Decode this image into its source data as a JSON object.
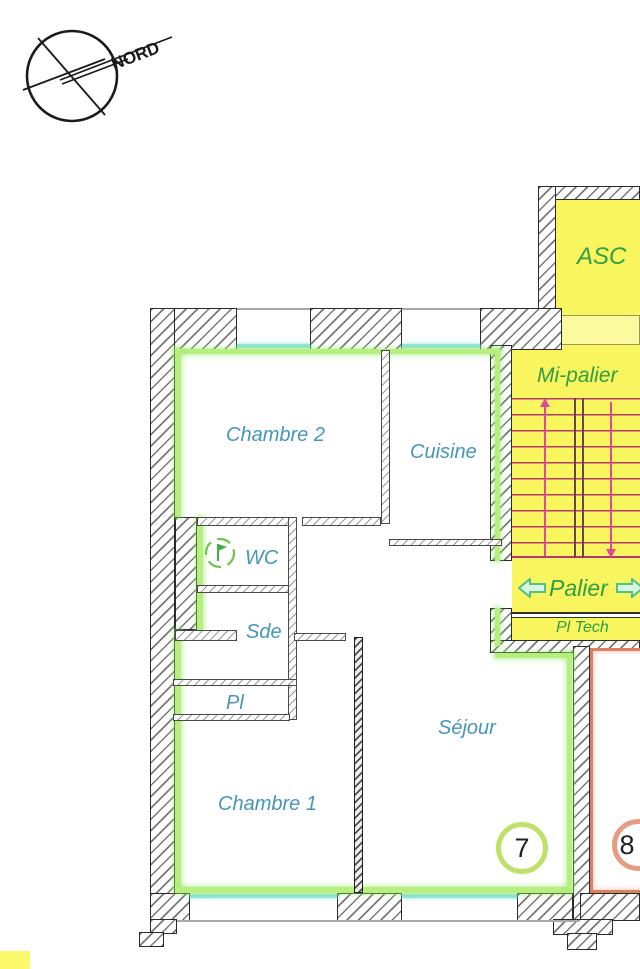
{
  "meta": {
    "type": "floor-plan",
    "orientation_label": "NORD"
  },
  "compass": {
    "north_label": "NORD"
  },
  "common_areas": {
    "elevator": "ASC",
    "half_landing": "Mi-palier",
    "landing": "Palier",
    "tech_closet": "Pl Tech"
  },
  "apartment_7": {
    "lot": "7",
    "rooms": {
      "chambre2": "Chambre 2",
      "cuisine": "Cuisine",
      "wc": "WC",
      "sde": "Sde",
      "pl": "Pl",
      "chambre1": "Chambre 1",
      "sejour": "Séjour"
    }
  },
  "apartment_8": {
    "lot": "8"
  },
  "colors": {
    "apartment7_outline": "#b6ef7c",
    "apartment8_outline": "#dd7d62",
    "common_area_fill": "#f8f55f",
    "stair_step_lines": "#b5396f",
    "stair_run_arrows": "#e04898",
    "window_glazing": "#8fe3de",
    "room_label_text": "#4596ba",
    "common_label_text": "#2f9e44",
    "wall_hatch": "#787878"
  }
}
